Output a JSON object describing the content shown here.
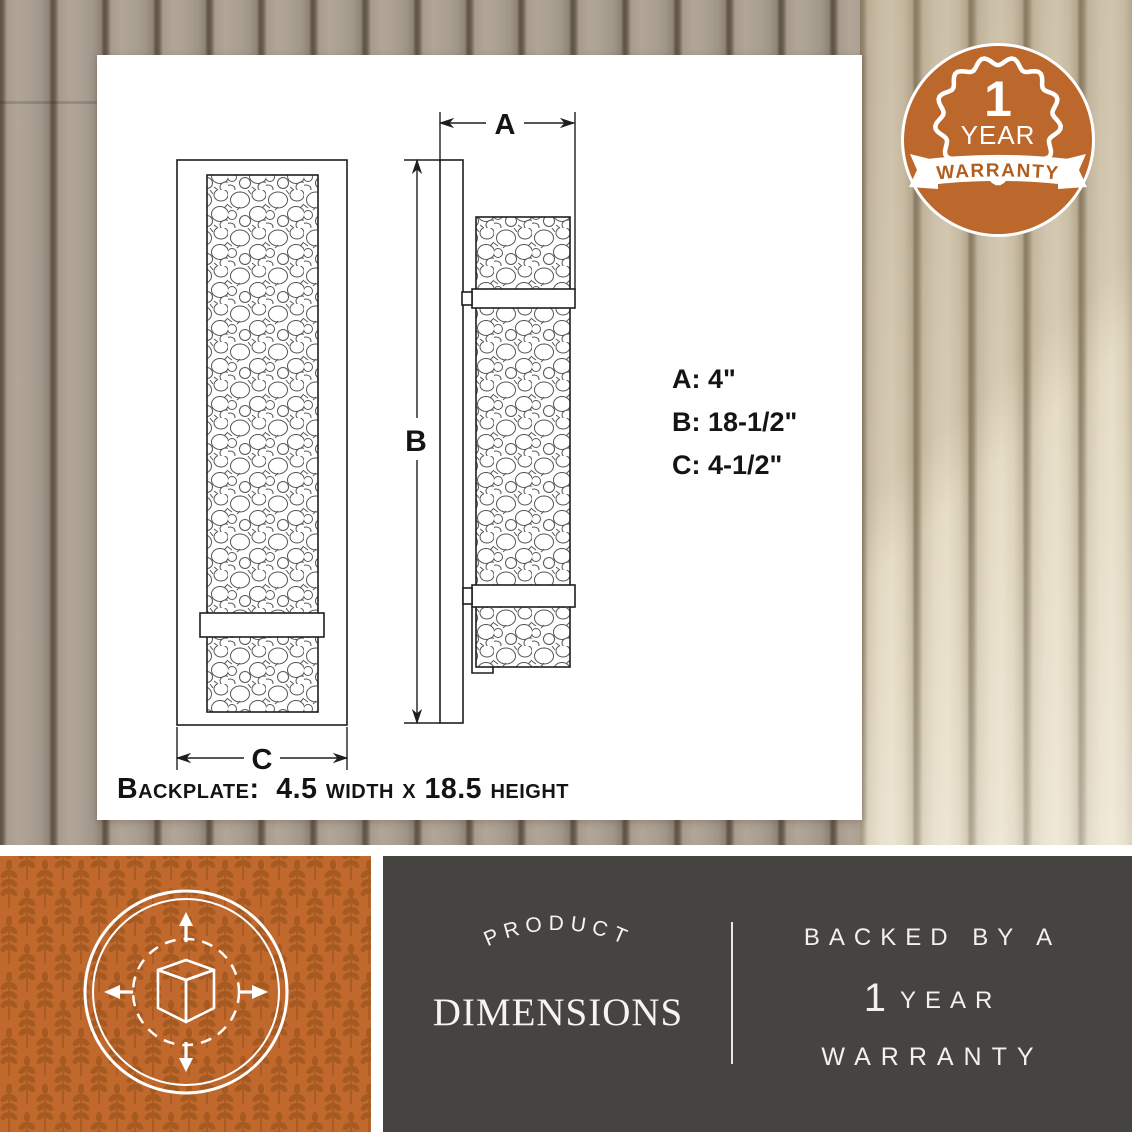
{
  "badge": {
    "number": "1",
    "year": "YEAR",
    "banner": "WARRANTY"
  },
  "diagram": {
    "labels": {
      "a": "A",
      "b": "B",
      "c": "C"
    },
    "specs": [
      {
        "text": "A: 4\""
      },
      {
        "text": "B: 18-1/2\""
      },
      {
        "text": "C: 4-1/2\""
      }
    ],
    "backplate_note": "Backplate:  4.5 width x 18.5 height"
  },
  "footer": {
    "icon": "dimensions-cube-icon",
    "arc_label": "PRODUCT",
    "title": "DIMENSIONS",
    "warranty": {
      "line1": "BACKED BY A",
      "number": "1",
      "year": "YEAR",
      "line3": "WARRANTY"
    }
  },
  "colors": {
    "accent_orange": "#bc672b",
    "footer_bg": "#454441"
  }
}
